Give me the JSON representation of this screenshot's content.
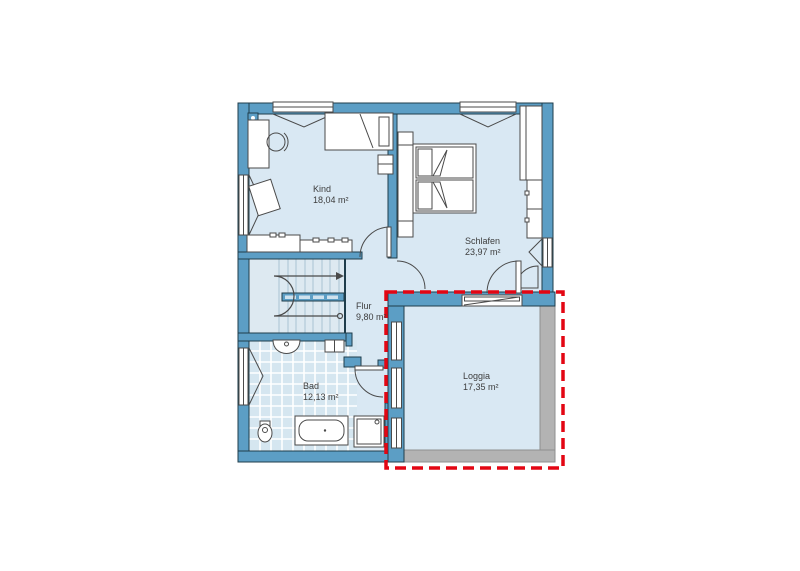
{
  "floorplan": {
    "type": "residential-upper-floor-plan",
    "rooms": [
      {
        "id": "kind",
        "name": "Kind",
        "area": "18,04 m²"
      },
      {
        "id": "schlafen",
        "name": "Schlafen",
        "area": "23,97 m²"
      },
      {
        "id": "flur",
        "name": "Flur",
        "area": "9,80 m²"
      },
      {
        "id": "bad",
        "name": "Bad",
        "area": "12,13 m²"
      },
      {
        "id": "loggia",
        "name": "Loggia",
        "area": "17,35 m²"
      }
    ],
    "highlight": {
      "target": "Loggia",
      "style": "red-dashed-rectangle"
    },
    "colors": {
      "wall": "#5c9ec5",
      "outline": "#1f3d4b",
      "floor": "#d9e8f3",
      "stairsfloor": "#dde9f1",
      "tile": "#d5e6f0",
      "tread": "#a9c2d2",
      "parapet": "#b3b3b3",
      "furniture_outline": "#4a4a4a",
      "highlight": "#e30613",
      "text": "#3d3d3d",
      "background": "#ffffff"
    }
  }
}
